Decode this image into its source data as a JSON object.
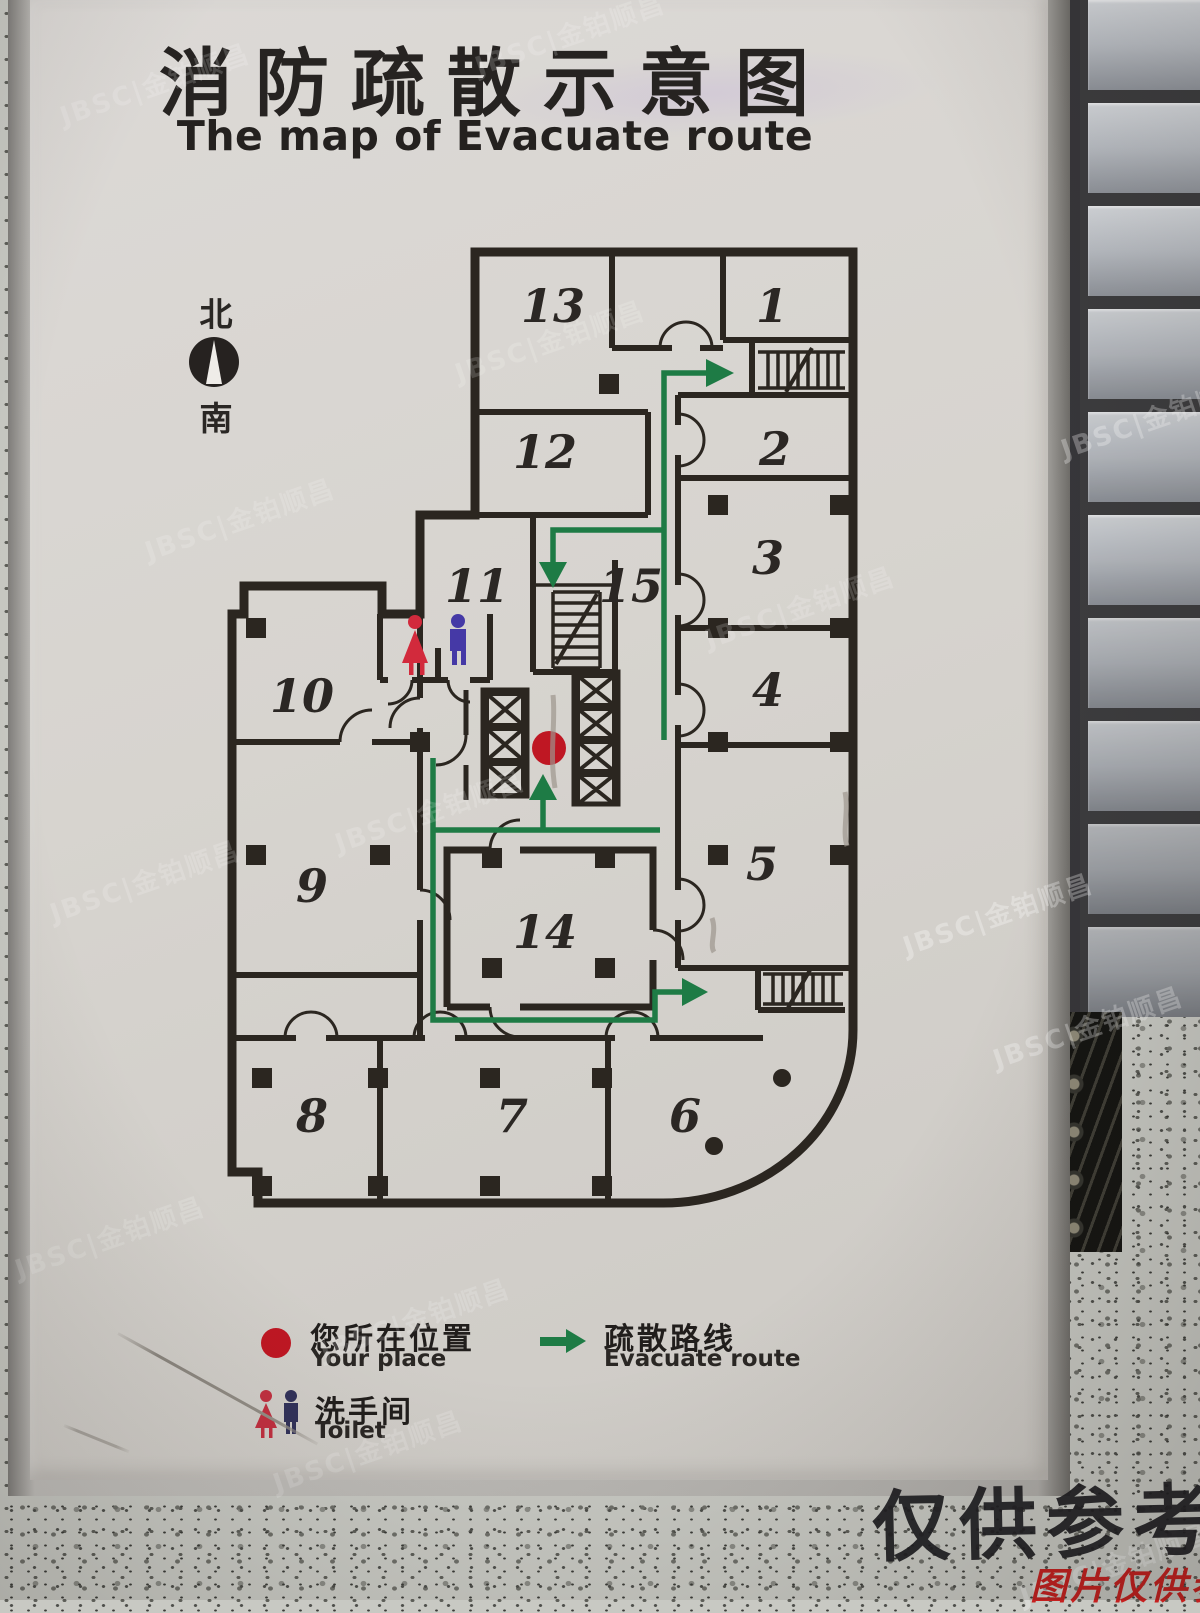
{
  "photo": {
    "sign": {
      "title_zh": "消防疏散示意图",
      "title_en": "The map of Evacuate route",
      "compass": {
        "north": "北",
        "south": "南"
      },
      "plan": {
        "rooms": [
          {
            "label": "1"
          },
          {
            "label": "2"
          },
          {
            "label": "3"
          },
          {
            "label": "4"
          },
          {
            "label": "5"
          },
          {
            "label": "6"
          },
          {
            "label": "7"
          },
          {
            "label": "8"
          },
          {
            "label": "9"
          },
          {
            "label": "10"
          },
          {
            "label": "11"
          },
          {
            "label": "12"
          },
          {
            "label": "13"
          },
          {
            "label": "14"
          },
          {
            "label": "15"
          }
        ]
      },
      "legend": {
        "your_place": {
          "zh": "您所在位置",
          "en": "Your place"
        },
        "route": {
          "zh": "疏散路线",
          "en": "Evacuate route"
        },
        "toilet": {
          "zh": "洗手间",
          "en": "Toilet"
        }
      },
      "colors": {
        "route_green": "#1e7b45",
        "marker_red": "#bf1723",
        "wall_ink": "#2b2620",
        "female_red": "#d22a3c",
        "male_blue": "#4539a6"
      }
    },
    "overlays": {
      "stamp_large": "仅供参考",
      "stamp_red": "图片仅供参考",
      "brand_watermark": "JBSC|金铂顺昌"
    }
  }
}
